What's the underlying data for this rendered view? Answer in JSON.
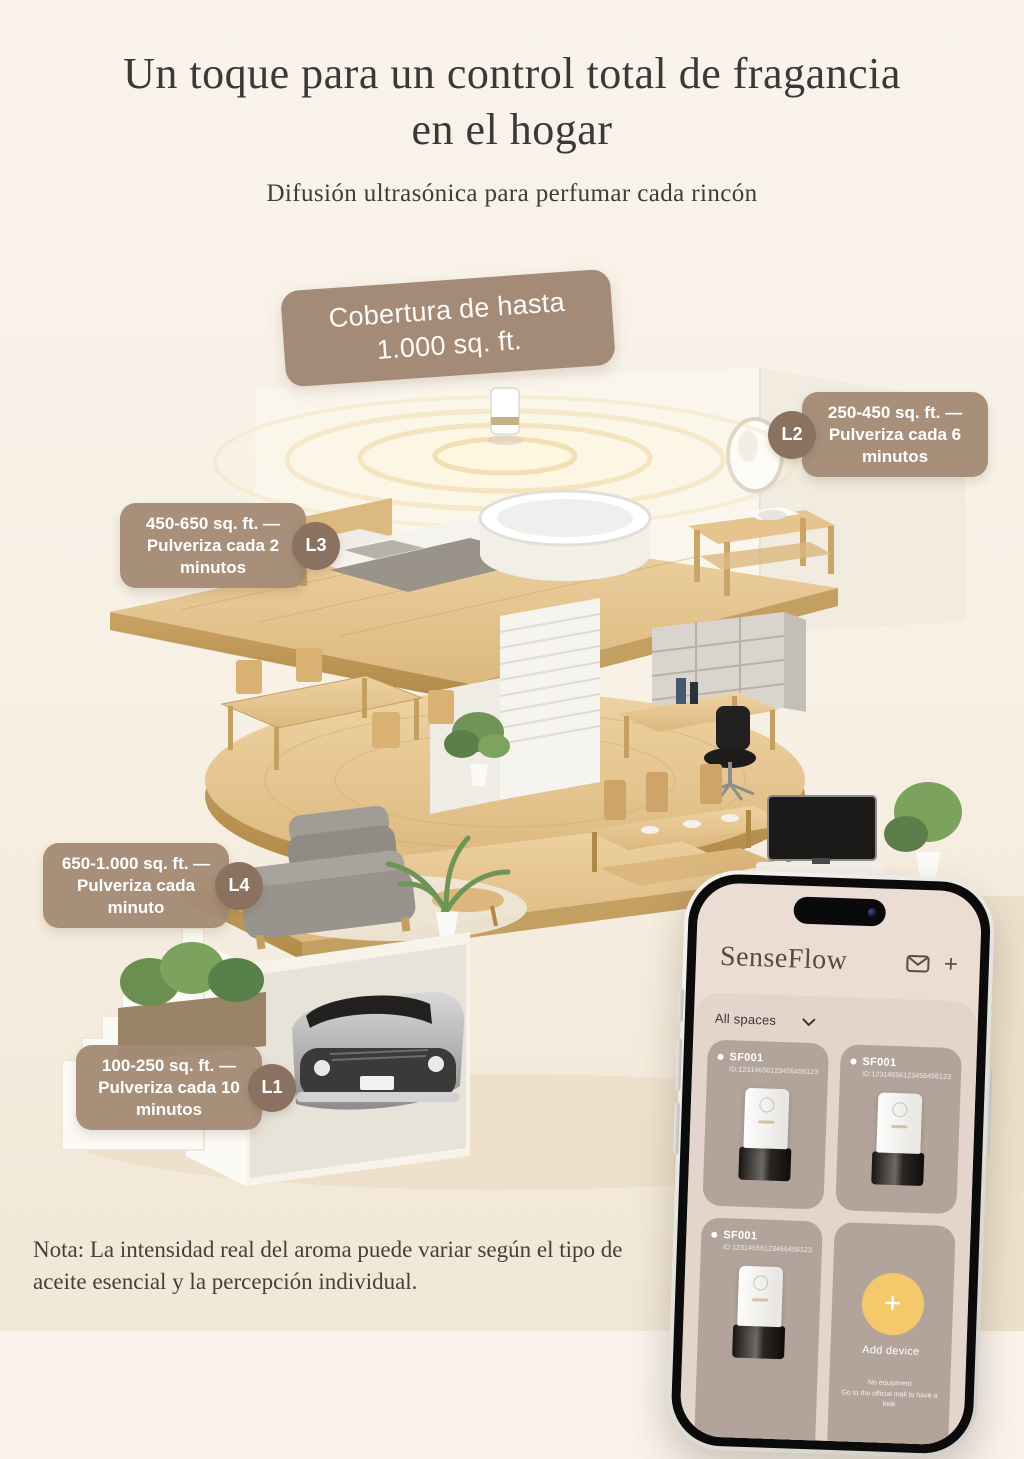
{
  "header": {
    "title_line1": "Un toque para un control total de fragancia",
    "title_line2": "en el hogar",
    "subtitle": "Difusión ultrasónica para perfumar cada rincón"
  },
  "coverage_badge": {
    "line1": "Cobertura de hasta",
    "line2": "1.000 sq. ft."
  },
  "callouts": [
    {
      "label": "L2",
      "lines": [
        "250-450 sq. ft. —",
        "Pulveriza cada 6",
        "minutos"
      ]
    },
    {
      "label": "L3",
      "lines": [
        "450-650 sq. ft. —",
        "Pulveriza cada 2",
        "minutos"
      ]
    },
    {
      "label": "L4",
      "lines": [
        "650-1.000 sq. ft. —",
        "Pulveriza cada",
        "minuto"
      ]
    },
    {
      "label": "L1",
      "lines": [
        "100-250 sq. ft. —",
        "Pulveriza cada 10",
        "minutos"
      ]
    }
  ],
  "phone": {
    "app_name": "SenseFlow",
    "filter_label": "All spaces",
    "cards": [
      {
        "name": "SF001",
        "device_id": "ID:12314656123456456123yyy"
      },
      {
        "name": "SF001",
        "device_id": "ID:12314656123456456123yyy"
      },
      {
        "name": "SF001",
        "device_id": "ID:12314656123456456123yyy"
      }
    ],
    "add_card": {
      "plus": "+",
      "label": "Add device",
      "hint_line1": "No equipment",
      "hint_line2": "Go to the official mall to have a look"
    }
  },
  "note": {
    "line1": "Nota: La intensidad real del aroma puede variar según el tipo de",
    "line2": "aceite esencial y la percepción individual."
  },
  "colors": {
    "callout_bubble": "#a38a75",
    "callout_dot": "#8b7260",
    "coverage_badge": "#a48b77",
    "phone_screen": "#ebdcd4",
    "panel": "#e3d4cc",
    "card": "#b2a49a",
    "add_button": "#f6c86c",
    "wood": "#e6c48f"
  }
}
